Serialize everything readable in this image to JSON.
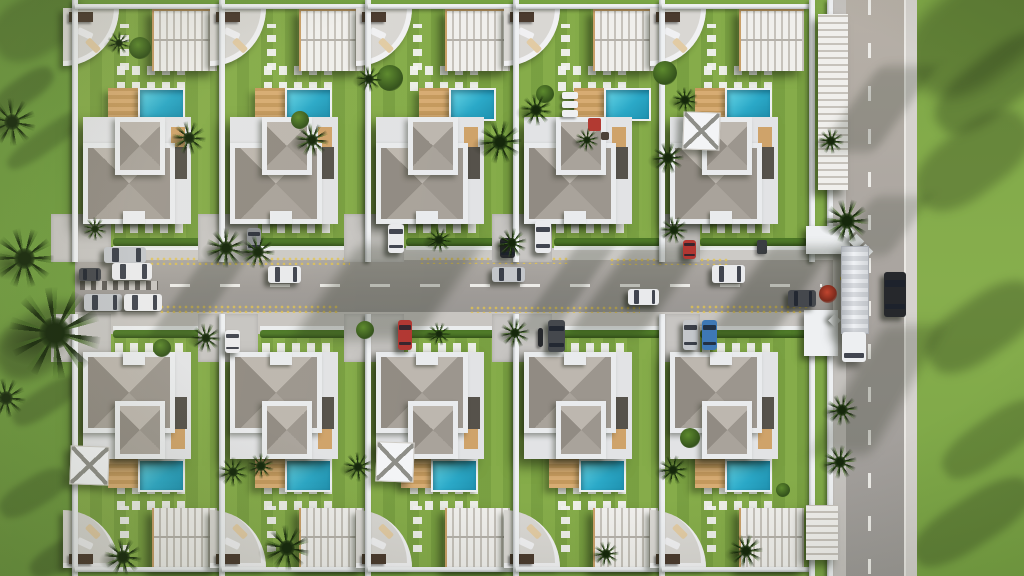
{
  "scene": {
    "title": "Aerial top-down 3D render of a gated villa community: two rows of five white villas with grey hip roofs, turquoise pools, wood decks, pergola carports, palm trees, a central street with cars and a perimeter road with a truck",
    "canvas": {
      "w": 1024,
      "h": 576
    },
    "palette": {
      "grass": "#75a242",
      "grassLeft": "#6d9a3e",
      "grassRight": "#82aa49",
      "lotLawn": "#7fa845",
      "hedge": "#4e7a28",
      "road": "#a19e9a",
      "sidewalk": "#cccac6",
      "apron": "#c7c5c2",
      "wall": "#eef0f2",
      "wallShade": "#b7babd",
      "trim": "#e9ebed",
      "roofTop": "#bdb7af",
      "roofRight": "#9c968e",
      "roofBottom": "#a9a39b",
      "roofLeft": "#918b83",
      "poolLight": "#68d5e5",
      "pool": "#2ba9c8",
      "poolDeep": "#1f90ae",
      "deckLight": "#d7ac73",
      "deckDark": "#c59a5e",
      "woodAccent": "#cfa36a",
      "darkAccent": "#56524b",
      "marking": "#edece8",
      "speckle": "#dfc05a",
      "palmDark": "#26421a",
      "shadow": "#16200e"
    },
    "development": {
      "lot_count": 10,
      "lots_per_row": 5,
      "lot_xs": [
        75,
        222,
        368,
        516,
        662
      ],
      "lot_w": 147,
      "row_top_y": 0,
      "row_bottom_y": 326,
      "row_h": 250,
      "right_wall_x": 809,
      "pool_shift_top_row": [
        0,
        0,
        0,
        18,
        25
      ]
    },
    "roads": {
      "main": {
        "x": 75,
        "y": 260,
        "w": 779,
        "h": 52,
        "dash_y": 284
      },
      "side": {
        "x": 846,
        "y": 0,
        "w": 58,
        "h": 576,
        "dash_x": 868,
        "left_sidewalk": [
          833,
          846
        ],
        "right_sidewalk": [
          904,
          917
        ],
        "boundary_wall_x": 827
      },
      "sidewalk_top": {
        "y": 248,
        "h": 12
      },
      "sidewalk_bottom": {
        "y": 312,
        "h": 24
      },
      "parking_hatch": [
        80,
        281,
        78,
        9
      ]
    },
    "vehicles": {
      "car_colors": {
        "white": "#e9eaec",
        "silver": "#c3c6ca",
        "gray": "#8a8d91",
        "darkgray": "#45484d",
        "black": "#26282c",
        "red": "#b23732",
        "blue": "#3e78b5"
      },
      "cars": [
        [
          104,
          247,
          42,
          16,
          "silver",
          "h"
        ],
        [
          112,
          263,
          40,
          17,
          "white",
          "h"
        ],
        [
          79,
          268,
          22,
          13,
          "darkgray",
          "h"
        ],
        [
          84,
          294,
          38,
          17,
          "silver",
          "h"
        ],
        [
          124,
          294,
          38,
          17,
          "white",
          "h"
        ],
        [
          268,
          266,
          33,
          17,
          "white",
          "h"
        ],
        [
          492,
          267,
          33,
          15,
          "silver",
          "h"
        ],
        [
          712,
          265,
          33,
          18,
          "white",
          "h"
        ],
        [
          628,
          289,
          31,
          16,
          "white",
          "h"
        ],
        [
          788,
          290,
          28,
          17,
          "darkgray",
          "h"
        ],
        [
          247,
          228,
          14,
          24,
          "gray",
          "v"
        ],
        [
          388,
          224,
          16,
          29,
          "white",
          "v"
        ],
        [
          500,
          238,
          15,
          20,
          "black",
          "v"
        ],
        [
          535,
          221,
          16,
          32,
          "white",
          "v"
        ],
        [
          683,
          240,
          13,
          19,
          "red",
          "v"
        ],
        [
          225,
          330,
          15,
          23,
          "white",
          "v"
        ],
        [
          398,
          320,
          14,
          30,
          "red",
          "v"
        ],
        [
          548,
          320,
          17,
          32,
          "darkgray",
          "v"
        ],
        [
          683,
          320,
          15,
          30,
          "silver",
          "v"
        ],
        [
          702,
          320,
          15,
          30,
          "blue",
          "v"
        ],
        [
          884,
          272,
          22,
          45,
          "black",
          "v"
        ]
      ],
      "truck": {
        "trailer": [
          841,
          246,
          26,
          86
        ],
        "cab": [
          842,
          332,
          24,
          30
        ]
      },
      "motorcycle": [
        538,
        328,
        5,
        19
      ]
    },
    "palms": [
      [
        55,
        333,
        46
      ],
      [
        12,
        122,
        24
      ],
      [
        24,
        258,
        30
      ],
      [
        6,
        398,
        20
      ],
      [
        189,
        138,
        17
      ],
      [
        226,
        248,
        20
      ],
      [
        258,
        252,
        17
      ],
      [
        312,
        140,
        17
      ],
      [
        500,
        142,
        22
      ],
      [
        536,
        110,
        16
      ],
      [
        512,
        243,
        15
      ],
      [
        515,
        333,
        15
      ],
      [
        668,
        158,
        16
      ],
      [
        685,
        100,
        13
      ],
      [
        674,
        230,
        14
      ],
      [
        847,
        221,
        22
      ],
      [
        831,
        141,
        13
      ],
      [
        842,
        410,
        16
      ],
      [
        840,
        462,
        17
      ],
      [
        206,
        338,
        15
      ],
      [
        233,
        472,
        15
      ],
      [
        358,
        467,
        15
      ],
      [
        287,
        548,
        23
      ],
      [
        123,
        557,
        19
      ],
      [
        261,
        466,
        13
      ],
      [
        673,
        470,
        15
      ],
      [
        746,
        551,
        17
      ],
      [
        606,
        554,
        13
      ],
      [
        119,
        43,
        12
      ],
      [
        369,
        79,
        13
      ],
      [
        95,
        229,
        12
      ],
      [
        439,
        240,
        13
      ],
      [
        439,
        334,
        12
      ],
      [
        587,
        140,
        12
      ]
    ],
    "bushes": [
      [
        140,
        48,
        11,
        "green"
      ],
      [
        390,
        78,
        13,
        "green"
      ],
      [
        665,
        73,
        12,
        "green"
      ],
      [
        545,
        94,
        9,
        "green"
      ],
      [
        300,
        120,
        9,
        "green"
      ],
      [
        162,
        348,
        9,
        "green"
      ],
      [
        690,
        438,
        10,
        "green"
      ],
      [
        365,
        330,
        9,
        "green"
      ],
      [
        828,
        294,
        9,
        "red"
      ],
      [
        783,
        490,
        7,
        "green"
      ]
    ],
    "canopies": [
      [
        683,
        112,
        35,
        36
      ],
      [
        70,
        446,
        37,
        37
      ],
      [
        376,
        442,
        36,
        38
      ]
    ],
    "poolside": {
      "loungers": [
        [
          562,
          92,
          16,
          7
        ],
        [
          562,
          101,
          16,
          7
        ],
        [
          562,
          110,
          16,
          7
        ]
      ],
      "red_mat": [
        588,
        118,
        13,
        13
      ],
      "table": [
        601,
        132,
        8,
        8
      ]
    },
    "bins": [
      [
        757,
        240,
        10,
        14
      ]
    ],
    "gate": {
      "top_block": [
        806,
        226,
        44,
        28
      ],
      "bottom_block": [
        804,
        310,
        34,
        46
      ],
      "diamonds": [
        [
          842,
          226,
          11
        ],
        [
          851,
          236,
          11
        ],
        [
          860,
          246,
          11
        ],
        [
          830,
          316,
          9
        ]
      ],
      "flag": [
        840,
        276,
        5,
        5
      ]
    },
    "carports_right": [
      [
        818,
        14,
        30,
        176
      ],
      [
        806,
        505,
        32,
        55
      ]
    ],
    "tree_shadows": [
      [
        -12,
        78,
        70,
        26,
        -35,
        0.28,
        3
      ],
      [
        0,
        128,
        95,
        22,
        -35,
        0.24,
        3
      ],
      [
        -8,
        312,
        100,
        58,
        -32,
        0.34,
        5
      ],
      [
        8,
        388,
        75,
        26,
        -33,
        0.26,
        3
      ],
      [
        -4,
        478,
        75,
        30,
        -31,
        0.24,
        3
      ],
      [
        26,
        538,
        85,
        28,
        -29,
        0.28,
        3
      ],
      [
        900,
        -14,
        150,
        95,
        -38,
        0.3,
        7
      ],
      [
        925,
        55,
        140,
        55,
        -38,
        0.28,
        5
      ],
      [
        908,
        128,
        130,
        65,
        -37,
        0.26,
        5
      ],
      [
        920,
        298,
        125,
        58,
        -35,
        0.28,
        5
      ],
      [
        935,
        418,
        115,
        42,
        -35,
        0.23,
        4
      ],
      [
        905,
        498,
        135,
        48,
        -33,
        0.26,
        4
      ],
      [
        -10,
        -6,
        95,
        60,
        -30,
        0.22,
        4
      ]
    ],
    "road_shadows": [
      [
        180,
        246,
        44,
        92,
        -35,
        0.2,
        4
      ],
      [
        325,
        244,
        125,
        96,
        -35,
        0.25,
        6
      ],
      [
        545,
        246,
        38,
        90,
        -35,
        0.2,
        4
      ],
      [
        598,
        246,
        75,
        90,
        -35,
        0.23,
        5
      ],
      [
        738,
        246,
        65,
        92,
        -35,
        0.25,
        5
      ],
      [
        846,
        325,
        62,
        130,
        -30,
        0.22,
        6
      ],
      [
        848,
        66,
        58,
        86,
        -36,
        0.2,
        5
      ],
      [
        852,
        196,
        58,
        60,
        -36,
        0.18,
        5
      ]
    ],
    "speckle_strips": [
      [
        150,
        257,
        200,
        8
      ],
      [
        420,
        257,
        150,
        7
      ],
      [
        610,
        258,
        120,
        7
      ],
      [
        160,
        305,
        180,
        8
      ],
      [
        470,
        306,
        170,
        7
      ],
      [
        690,
        305,
        120,
        8
      ],
      [
        240,
        222,
        60,
        6
      ],
      [
        560,
        338,
        80,
        6
      ]
    ]
  }
}
